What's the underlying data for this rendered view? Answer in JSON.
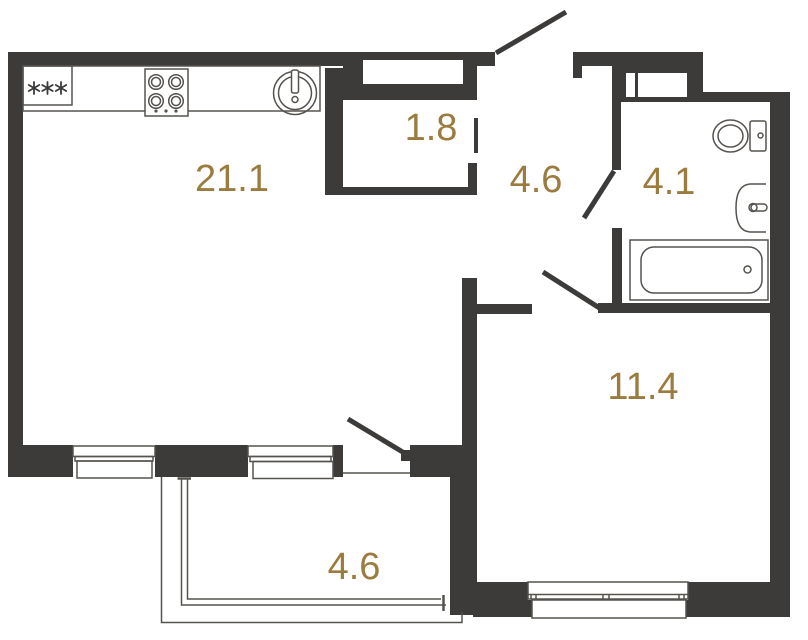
{
  "plan": {
    "type": "apartment-floor-plan",
    "units": "m2"
  },
  "rooms": {
    "living": {
      "name": "kitchen-living-room",
      "label": "21.1"
    },
    "wardrobe": {
      "name": "wardrobe",
      "label": "1.8"
    },
    "hall": {
      "name": "hallway",
      "label": "4.6"
    },
    "bathroom": {
      "name": "bathroom",
      "label": "4.1"
    },
    "bedroom": {
      "name": "bedroom",
      "label": "11.4"
    },
    "balcony": {
      "name": "balcony",
      "label": "4.6"
    }
  },
  "kitchen": {
    "fridge_symbol": "***"
  },
  "colors": {
    "wall": "#3D3B39",
    "line": "#56534F",
    "label": "#9C7B3E",
    "bg": "#FFFFFF"
  }
}
